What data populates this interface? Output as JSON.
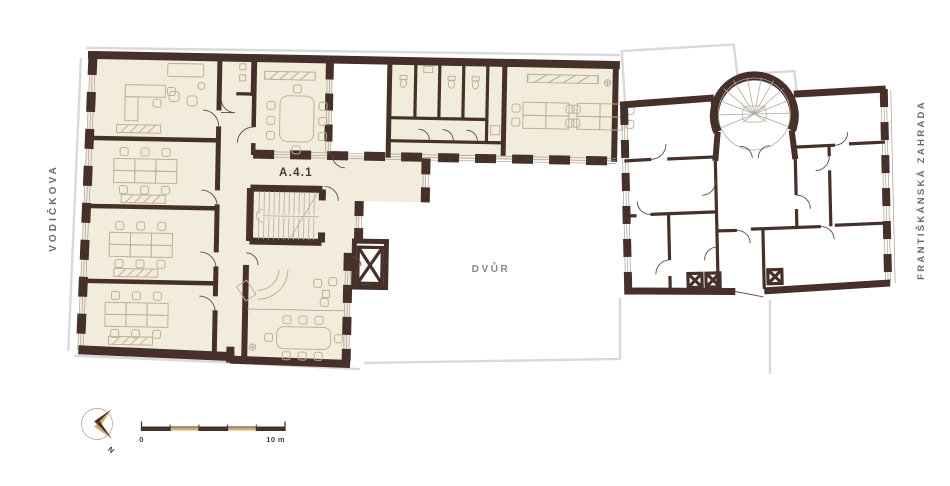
{
  "title": "Floor plan",
  "labels": {
    "unit": "A.4.1",
    "courtyard": "DVŮR",
    "street_left": "VODIČKOVA",
    "street_right": "FRANTIŠKÁNSKÁ ZAHRADA"
  },
  "compass": {
    "north_label": "N"
  },
  "scale_bar": {
    "start_label": "0",
    "end_label": "10 m"
  },
  "colors": {
    "wall": "#46302a",
    "room_fill": "#f2ecdc",
    "accent_tan": "#d2ab67",
    "outline_gray": "#d9d9dc",
    "furniture": "#bfb197",
    "furniture_gray": "#b3aaa2",
    "label_dark": "#4b3a31",
    "label_gray": "#8b857f",
    "street_text": "#6f6963",
    "door": "#5f4a3e",
    "window_line": "#a79d90"
  }
}
